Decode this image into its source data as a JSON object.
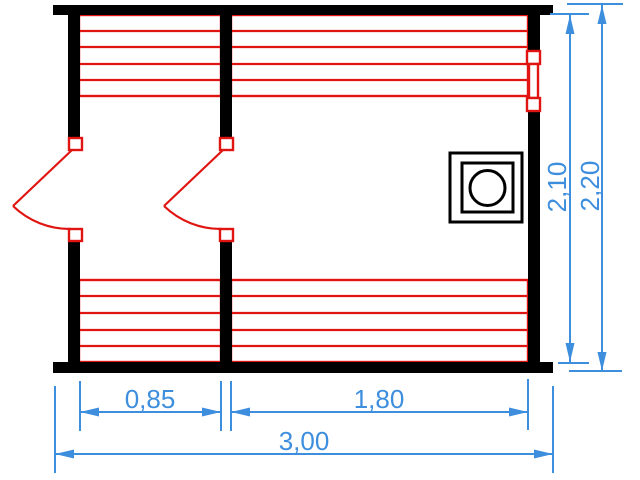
{
  "colors": {
    "structure": "#000000",
    "fixtures": "#e01511",
    "dimensions": "#3e8ede",
    "background": "#ffffff"
  },
  "dimensions": {
    "left_section_width": {
      "label": "0,85",
      "meters": 0.85
    },
    "right_section_width": {
      "label": "1,80",
      "meters": 1.8
    },
    "total_width": {
      "label": "3,00",
      "meters": 3.0
    },
    "inner_height": {
      "label": "2,10",
      "meters": 2.1
    },
    "outer_height": {
      "label": "2,20",
      "meters": 2.2
    }
  },
  "symbols": {
    "stove": "square-in-square-with-circle",
    "window": "double-frame-window",
    "door_left": "door-swing-arc",
    "door_middle": "door-swing-arc",
    "benches": "parallel-slat-bench"
  }
}
